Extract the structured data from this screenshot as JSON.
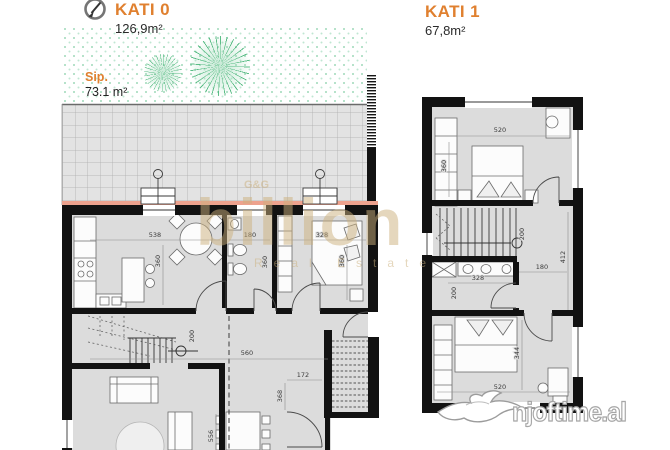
{
  "header": {
    "floor0_title": "KATI 0",
    "floor0_area": "126,9m²",
    "floor1_title": "KATI 1",
    "floor1_area": "67,8m²"
  },
  "garden": {
    "label": "Sip.",
    "area": "73.1 m²"
  },
  "dims_kati0": {
    "kitchen_width": "538",
    "kitchen_depth": "360",
    "bath_width": "180",
    "bath_depth": "360",
    "bedroom_width": "328",
    "bedroom_depth": "360",
    "stair_width": "200",
    "hall_width": "560",
    "ext_stair_width": "172",
    "ext_stair_depth": "368",
    "dining_depth": "556"
  },
  "dims_kati1": {
    "bedroom1_width": "520",
    "bedroom1_depth": "360",
    "stair_depth": "200",
    "bath_width": "328",
    "bath_depth": "200",
    "hall_width": "180",
    "hall_depth": "412",
    "bedroom2_depth": "344",
    "bedroom2_width": "520"
  },
  "watermarks": {
    "brand_g": "G&G",
    "brand": "billion",
    "brand_sub": "Real Estate",
    "site": "njoftime.al"
  },
  "colors": {
    "accent_orange": "#E0802F",
    "wall_black": "#121212",
    "floor_gray": "#DCDCDC",
    "wall_salmon": "#EDA28E",
    "lawn_green": "#9FD9BA",
    "watermark_tan": "#CBAF7C"
  }
}
